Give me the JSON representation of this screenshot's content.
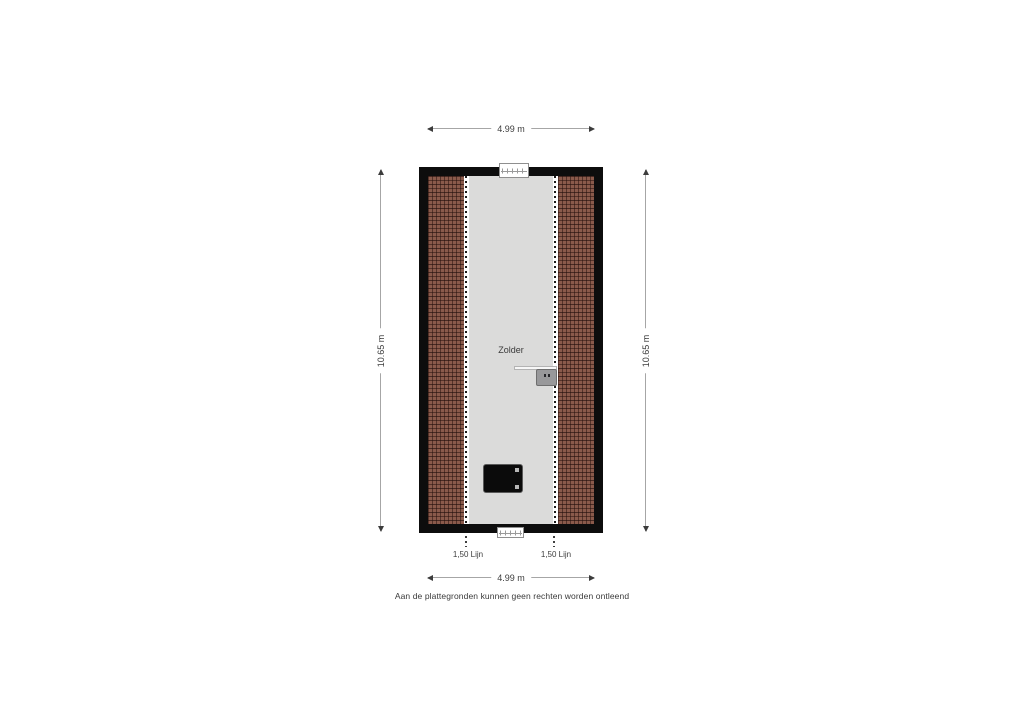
{
  "floorplan": {
    "room_label": "Zolder",
    "dimensions": {
      "top": "4.99 m",
      "bottom": "4.99 m",
      "left": "10.65 m",
      "right": "10.65 m"
    },
    "height_lines": {
      "left_label": "1,50 Lijn",
      "right_label": "1,50 Lijn"
    },
    "disclaimer": "Aan de plattegronden kunnen geen rechten worden ontleend",
    "colors": {
      "wall": "#0d0d0d",
      "floor": "#dbdbda",
      "roof_tile": "#8a5a4b",
      "roof_tile_grout": "#3c1f18",
      "dimension_line": "#a6a6a6",
      "text": "#3c3c3c",
      "boiler": "#98989a",
      "hatch": "#0b0b0b"
    }
  }
}
